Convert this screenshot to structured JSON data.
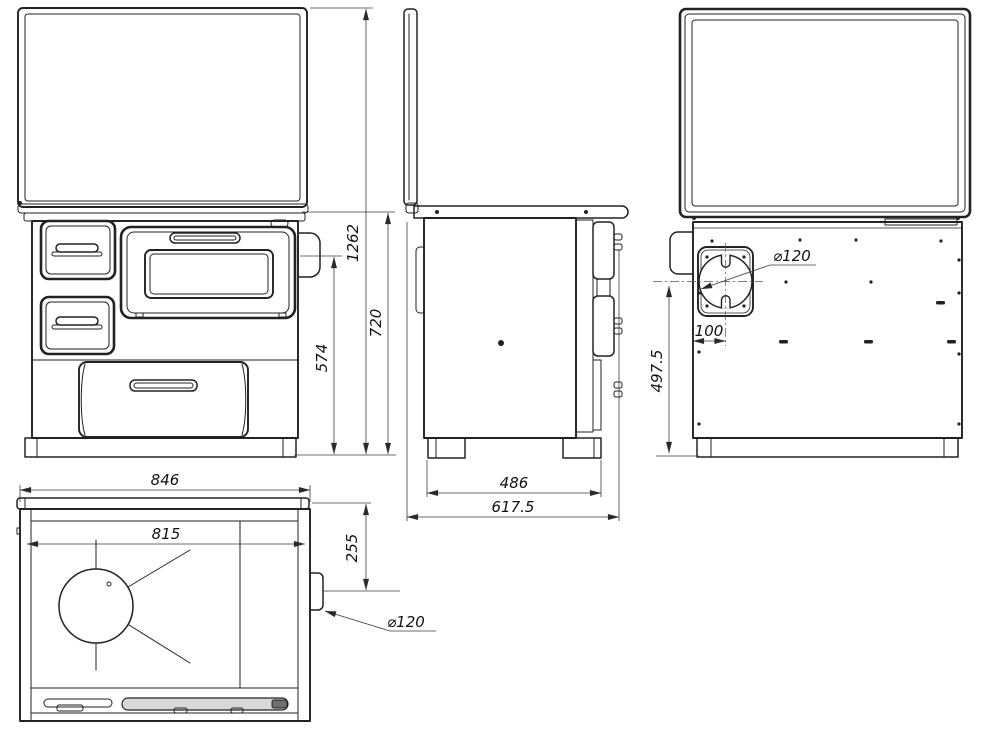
{
  "colors": {
    "background": "#ffffff",
    "line": "#222222",
    "dim_line": "#3c3c3c",
    "handle_fill": "#d8d8d8",
    "handle_cap": "#6f6f6f"
  },
  "dimensions": {
    "front_view": {
      "overall_height": "1262",
      "body_height": "720",
      "flue_outlet_height": "574"
    },
    "side_view": {
      "feet_depth": "486",
      "overall_depth": "617.5"
    },
    "back_view": {
      "flue_diameter": "⌀120",
      "flue_offset": "100",
      "flue_height": "497.5"
    },
    "top_view": {
      "overall_width": "846",
      "plate_width": "815",
      "flue_from_back": "255",
      "flue_diameter": "⌀120"
    }
  }
}
